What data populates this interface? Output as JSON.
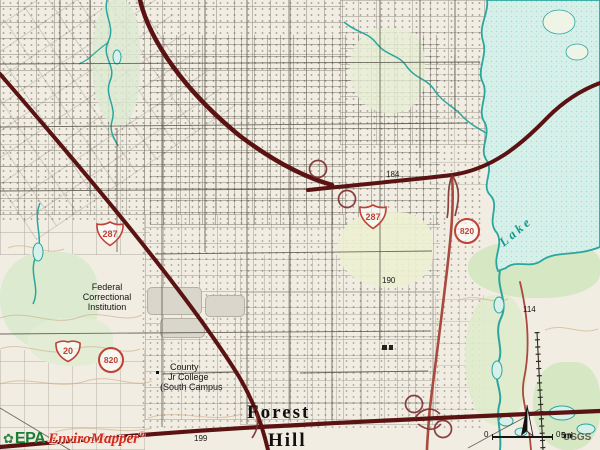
{
  "map": {
    "attribution": {
      "epa": "EPA",
      "product": "EnviroMapper",
      "registered": "®",
      "source": "USGS"
    },
    "scale_bar": {
      "zero_left": "0",
      "zero_right": "0",
      "unit": "5mi"
    },
    "shields": {
      "us287_nw": "287",
      "us287_center": "287",
      "i820_center": "820",
      "i20_sw": "20",
      "i820_sw": "820"
    },
    "labels": {
      "federal_line1": "Federal",
      "federal_line2": "Correctional",
      "federal_line3": "Institution",
      "college_line1": "County",
      "college_line2": "Jr College",
      "college_line3": "(South Campus",
      "city_line1": "Forest",
      "city_line2": "Hill",
      "lake": "Lake",
      "elev_184": "184",
      "elev_190": "190",
      "elev_199": "199",
      "elev_114": "114"
    },
    "icons": {
      "epa_flower_icon": "✿",
      "north_arrow_icon": "compass-needle"
    },
    "colors": {
      "paper": "#f1ede2",
      "highway_major": "#5a1212",
      "highway_secondary": "#a84a3d",
      "route_shield_red": "#bf4136",
      "water_fill": "#d8f0ea",
      "water_line": "#2aa69e",
      "lake_label": "#18988f",
      "contour": "#c9a57a",
      "epa_green": "#1d7c38",
      "logo_red": "#cc2d1d",
      "usgs_gray": "#635f55"
    }
  }
}
